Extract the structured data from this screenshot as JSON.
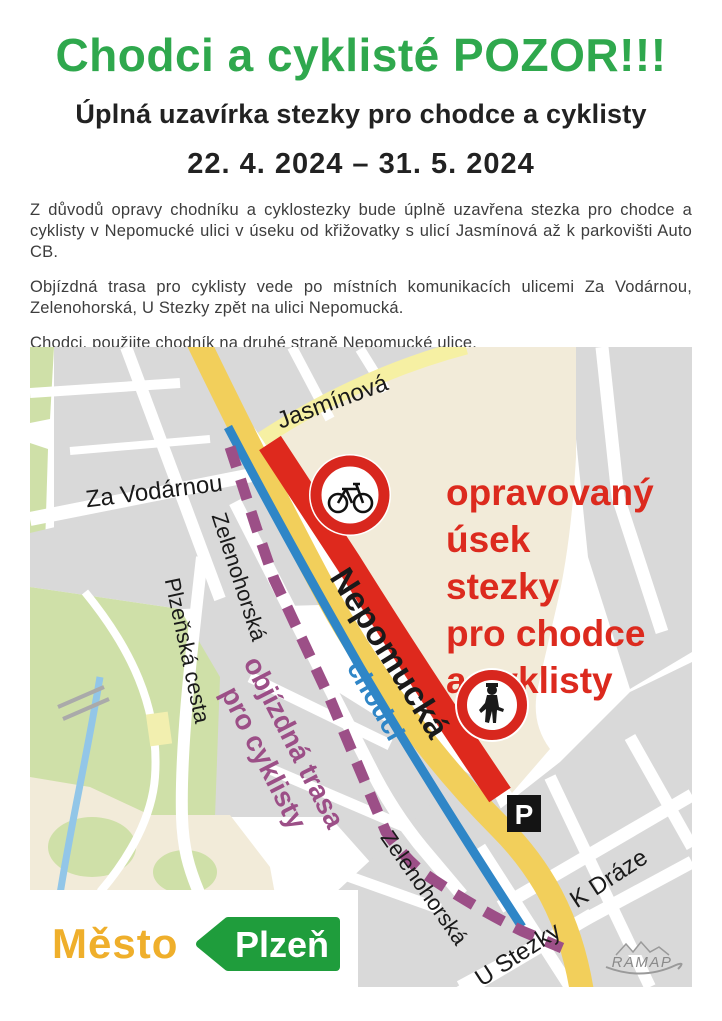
{
  "poster": {
    "headline": "Chodci a cyklisté POZOR!!!",
    "subtitle": "Úplná uzavírka stezky pro chodce a cyklisty",
    "date_range": "22. 4. 2024 – 31. 5. 2024",
    "paragraphs": [
      "Z důvodů opravy chodníku a cyklostezky bude úplně uzavřena stezka pro chodce a cyklisty v Nepomucké ulici v úseku od křižovatky s ulicí Jasmínová až k parkovišti Auto CB.",
      "Objízdná trasa pro cyklisty vede po místních komunikacích ulicemi Za Vodárnou, Zelenohorská, U Stezky zpět na ulici Nepomucká.",
      "Chodci, použijte chodník na druhé straně Nepomucké ulice."
    ]
  },
  "map": {
    "street_labels": {
      "jasminova": "Jasmínová",
      "za_vodarnou": "Za Vodárnou",
      "zelenohorska_upper": "Zelenohorská",
      "plzenska_cesta": "Plzeňská cesta",
      "nepomucka": "Nepomucká",
      "chodci": "chodci",
      "zelenohorska_lower": "Zelenohorská",
      "u_stezky": "U Stezky",
      "k_draze": "K Dráze"
    },
    "annotations": {
      "repair_lines": [
        "opravovaný",
        "úsek",
        "stezky",
        "pro chodce",
        "a cyklisty"
      ],
      "detour_line1": "objízdná trasa",
      "detour_line2": "pro cyklisty",
      "parking_label": "P"
    },
    "icons": [
      "no-bicycles-sign",
      "no-pedestrians-sign",
      "parking-sign"
    ],
    "attribution": "RAMAP",
    "colors": {
      "closure_red": "#DE291D",
      "detour_purple": "#9C4F87",
      "pedestrian_blue": "#2F86C7",
      "road_yellow": "#F2CF5B",
      "road_pale_yellow": "#F6F0A3",
      "area_beige": "#F2EBD9",
      "block_gray": "#D9D9D9",
      "park_green": "#CFE0A8",
      "stream_blue": "#92C6E8"
    }
  },
  "footer_logo": {
    "city_word": "Město",
    "city_name": "Plzeň",
    "gold": "#EFAF2B",
    "green": "#1F9D3C"
  }
}
